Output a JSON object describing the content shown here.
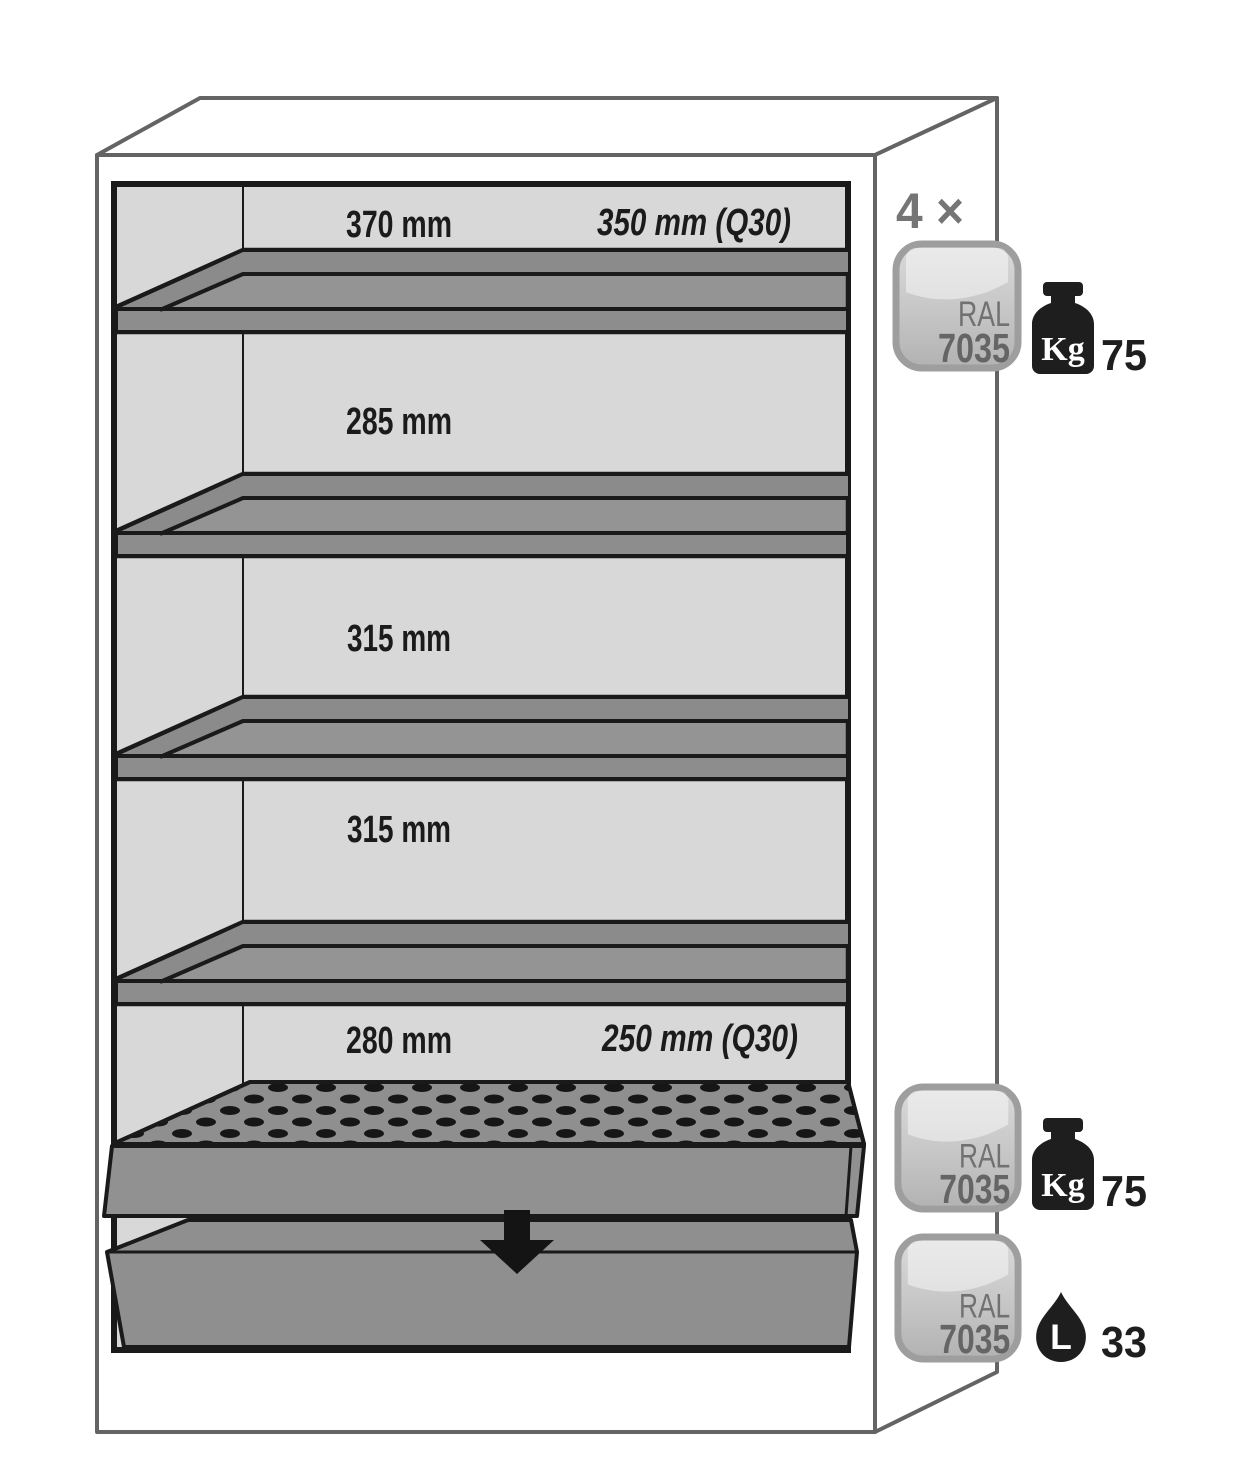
{
  "page": {
    "background": "#ffffff"
  },
  "diagram": {
    "type": "safety-cabinet-interior-dimensions",
    "sections": [
      {
        "width_label": "370 mm",
        "q30_label": "350 mm (Q30)"
      },
      {
        "width_label": "285 mm"
      },
      {
        "width_label": "315 mm"
      },
      {
        "width_label": "315 mm"
      },
      {
        "width_label": "280 mm",
        "q30_label": "250 mm (Q30)"
      }
    ],
    "shelves_multiplier_label": "4 ×",
    "color_badge": {
      "line1": "RAL",
      "line2": "7035"
    },
    "load_badges": [
      {
        "icon": "weight-kg-icon",
        "unit": "Kg",
        "value": "75"
      },
      {
        "icon": "weight-kg-icon",
        "unit": "Kg",
        "value": "75"
      },
      {
        "icon": "liter-drop-icon",
        "unit": "L",
        "value": "33"
      }
    ],
    "colors": {
      "outer_outline": "#646464",
      "interior_fill": "#d8d8d8",
      "shelf_fill": "#949494",
      "shelf_dark_fill": "#8b8b8b",
      "detail_stroke": "#1a1a1a",
      "badge_border": "#9e9e9e",
      "badge_fill_top": "#d9d9d9",
      "badge_fill_bottom": "#b4b4b4",
      "badge_text": "#6a6a6a",
      "icon_black": "#1e1e1e",
      "muted_gray": "#757575"
    }
  }
}
